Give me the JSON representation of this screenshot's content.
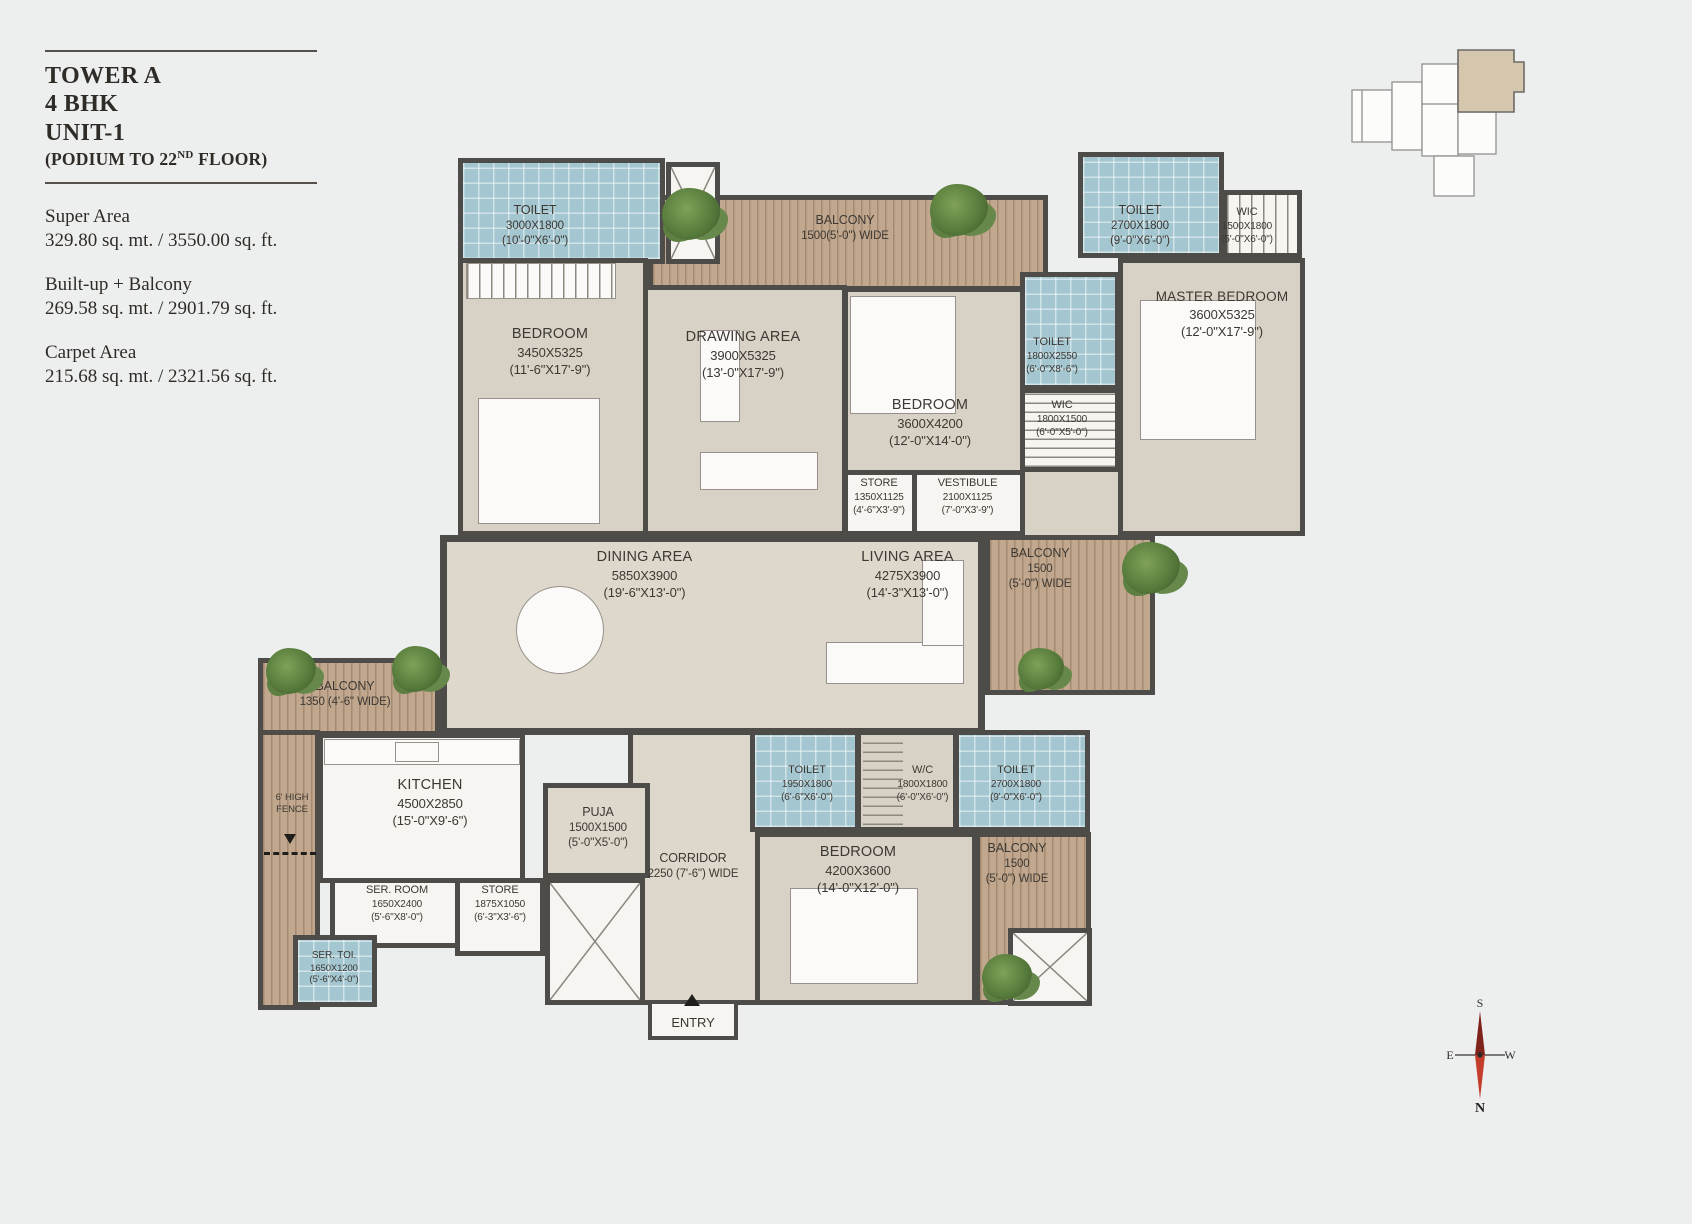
{
  "info": {
    "title_lines": [
      "TOWER A",
      "4 BHK",
      "UNIT-1"
    ],
    "subtitle_pre": "(PODIUM TO 22",
    "subtitle_sup": "ND",
    "subtitle_post": " FLOOR)",
    "areas": [
      {
        "label": "Super Area",
        "value": "329.80 sq. mt. / 3550.00 sq. ft."
      },
      {
        "label": "Built-up + Balcony",
        "value": "269.58 sq. mt. / 2901.79 sq. ft."
      },
      {
        "label": "Carpet Area",
        "value": "215.68 sq. mt. / 2321.56 sq. ft."
      }
    ]
  },
  "plan": {
    "entry_label": "ENTRY",
    "rooms": [
      {
        "name": "TOILET",
        "mm": "3000X1800",
        "ft": "(10'-0\"X6'-0\")"
      },
      {
        "name": "BEDROOM",
        "mm": "3450X5325",
        "ft": "(11'-6\"X17'-9\")"
      },
      {
        "name": "DRAWING AREA",
        "mm": "3900X5325",
        "ft": "(13'-0\"X17'-9\")"
      },
      {
        "name": "BALCONY",
        "mm": "1500(5'-0\") WIDE",
        "ft": ""
      },
      {
        "name": "BEDROOM",
        "mm": "3600X4200",
        "ft": "(12'-0\"X14'-0\")"
      },
      {
        "name": "TOILET",
        "mm": "2700X1800",
        "ft": "(9'-0\"X6'-0\")"
      },
      {
        "name": "WIC",
        "mm": "1500X1800",
        "ft": "(5'-0\"X6'-0\")"
      },
      {
        "name": "MASTER BEDROOM",
        "mm": "3600X5325",
        "ft": "(12'-0\"X17'-9\")"
      },
      {
        "name": "TOILET",
        "mm": "1800X2550",
        "ft": "(6'-0\"X8'-6\")"
      },
      {
        "name": "WIC",
        "mm": "1800X1500",
        "ft": "(6'-0\"X5'-0\")"
      },
      {
        "name": "STORE",
        "mm": "1350X1125",
        "ft": "(4'-6\"X3'-9\")"
      },
      {
        "name": "VESTIBULE",
        "mm": "2100X1125",
        "ft": "(7'-0\"X3'-9\")"
      },
      {
        "name": "DINING AREA",
        "mm": "5850X3900",
        "ft": "(19'-6\"X13'-0\")"
      },
      {
        "name": "LIVING AREA",
        "mm": "4275X3900",
        "ft": "(14'-3\"X13'-0\")"
      },
      {
        "name": "BALCONY",
        "mm": "1500",
        "ft": "(5'-0\") WIDE"
      },
      {
        "name": "BALCONY",
        "mm": "1350  (4'-6\" WIDE)",
        "ft": ""
      },
      {
        "name": "KITCHEN",
        "mm": "4500X2850",
        "ft": "(15'-0\"X9'-6\")"
      },
      {
        "name": "PUJA",
        "mm": "1500X1500",
        "ft": "(5'-0\"X5'-0\")"
      },
      {
        "name": "CORRIDOR",
        "mm": "2250 (7'-6\") WIDE",
        "ft": ""
      },
      {
        "name": "SER. ROOM",
        "mm": "1650X2400",
        "ft": "(5'-6\"X8'-0\")"
      },
      {
        "name": "STORE",
        "mm": "1875X1050",
        "ft": "(6'-3\"X3'-6\")"
      },
      {
        "name": "SER. TOI.",
        "mm": "1650X1200",
        "ft": "(5'-6\"X4'-0\")"
      },
      {
        "name": "TOILET",
        "mm": "1950X1800",
        "ft": "(6'-6\"X6'-0\")"
      },
      {
        "name": "W/C",
        "mm": "1800X1800",
        "ft": "(6'-0\"X6'-0\")"
      },
      {
        "name": "TOILET",
        "mm": "2700X1800",
        "ft": "(9'-0\"X6'-0\")"
      },
      {
        "name": "BEDROOM",
        "mm": "4200X3600",
        "ft": "(14'-0\"X12'-0\")"
      },
      {
        "name": "BALCONY",
        "mm": "1500",
        "ft": "(5'-0\") WIDE"
      },
      {
        "name": "6' HIGH",
        "mm": "FENCE",
        "ft": ""
      }
    ]
  },
  "compass": {
    "top": "S",
    "left": "E",
    "right": "W",
    "bottom": "N"
  },
  "colors": {
    "background": "#edefee",
    "wall": "#4e4c49",
    "room_floor": "#d8d1c5",
    "tile_blue": "#a3c6d0",
    "balcony_wood": "#c0a78d",
    "keyplan_highlight": "#d5c6ae",
    "compass_red": "#c43d2c"
  }
}
